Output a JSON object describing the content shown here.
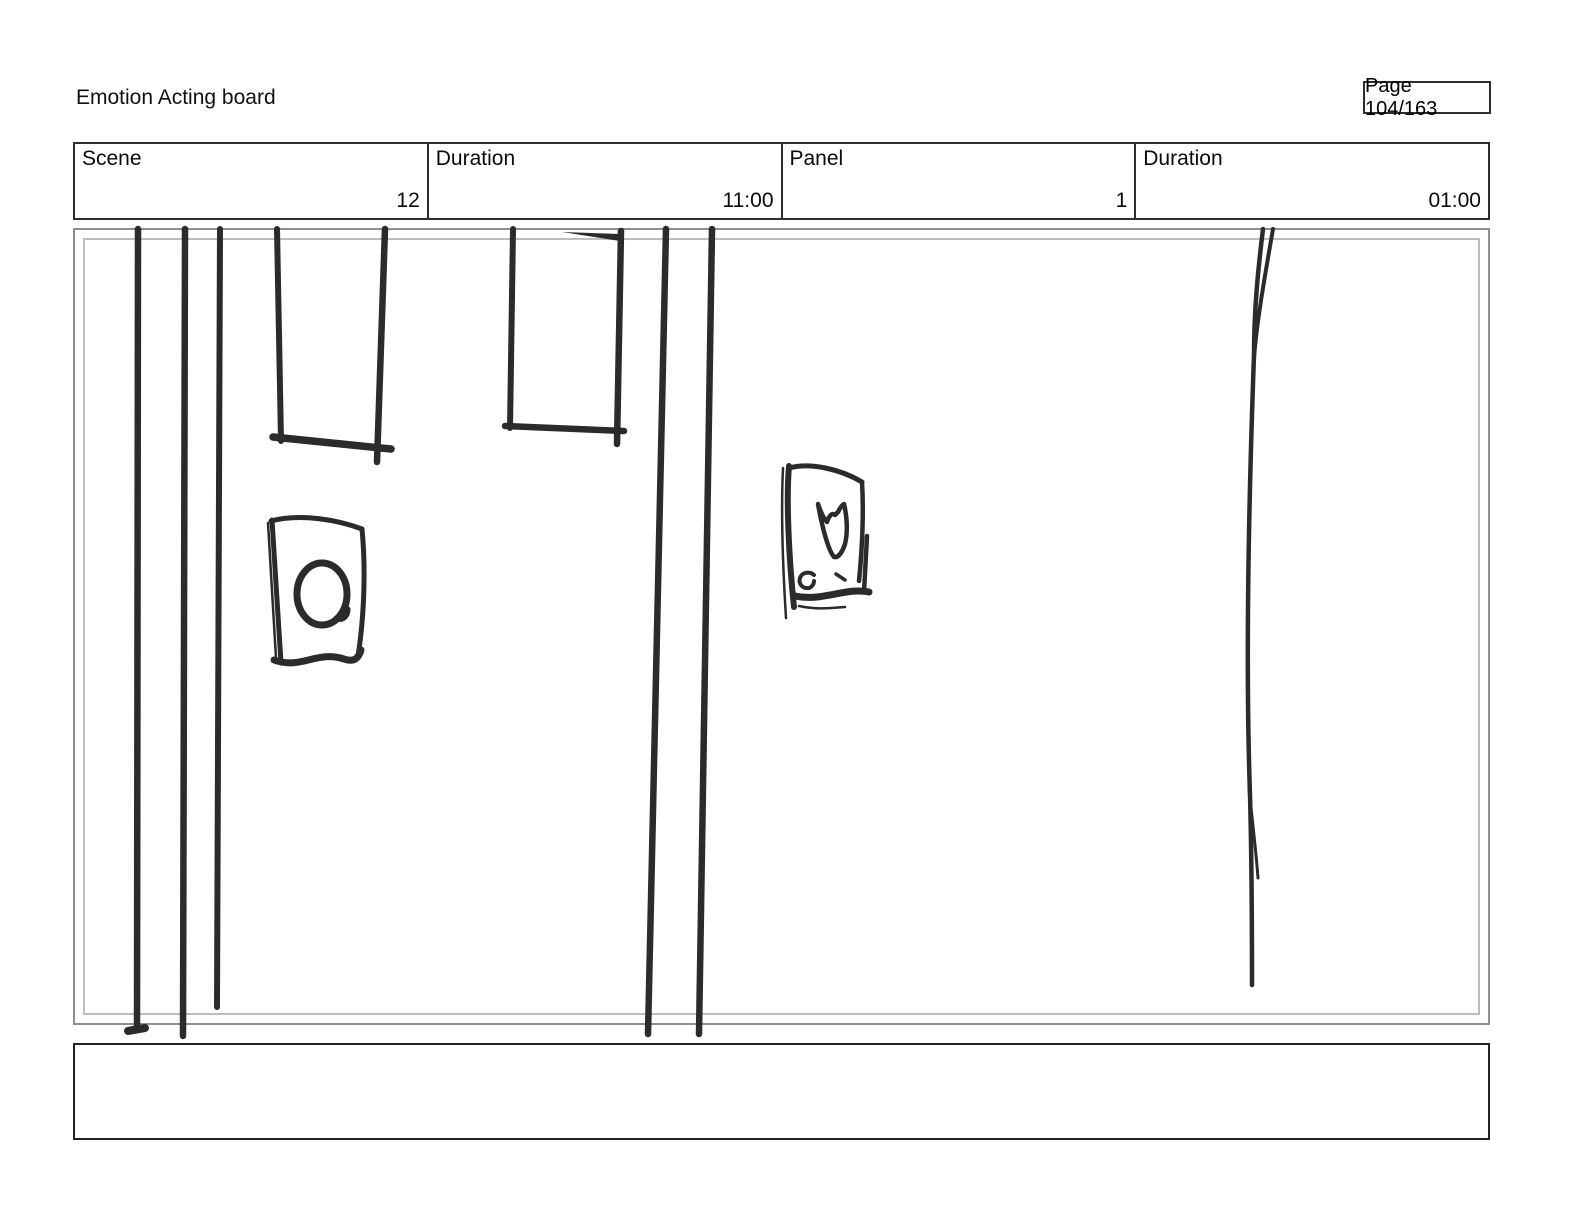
{
  "header": {
    "title": "Emotion Acting board",
    "page_label": "Page 104/163"
  },
  "info_table": {
    "cells": [
      {
        "label": "Scene",
        "value": "12"
      },
      {
        "label": "Duration",
        "value": "11:00"
      },
      {
        "label": "Panel",
        "value": "1"
      },
      {
        "label": "Duration",
        "value": "01:00"
      }
    ]
  },
  "panel": {
    "sketch_elements": [
      "three-vertical-pole-lines-left",
      "hanging-frame-left",
      "hanging-frame-center",
      "poster-with-circle",
      "poster-with-y-shape",
      "two-vertical-pole-lines-center",
      "long-forked-vertical-line-right"
    ]
  },
  "notes": {
    "text": ""
  },
  "colors": {
    "background": "#ffffff",
    "text": "#000000",
    "table_border": "#2e2e2e",
    "panel_border_outer": "#8f8f8f",
    "panel_border_inner": "#bdbdbd",
    "sketch_stroke": "#2b2b2b"
  }
}
